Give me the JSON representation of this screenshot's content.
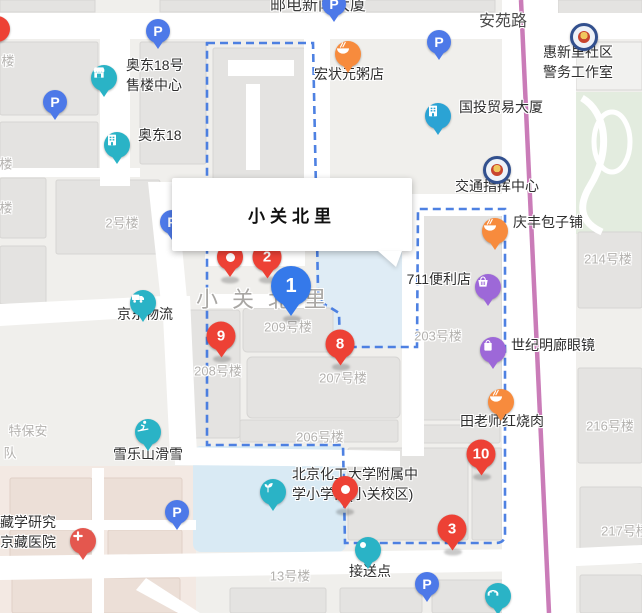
{
  "map": {
    "road_name": "安苑路",
    "top_building_label": "邮电新闻大厦",
    "area_label": "小关北里",
    "info_window": {
      "title": "小关北里"
    },
    "colors": {
      "red_marker": "#ed4135",
      "blue_marker": "#3579ea",
      "parking_blue": "#4d79e8",
      "teal": "#2ab3c6",
      "office_blue": "#2ba3d4",
      "orange": "#f78b3d",
      "purple": "#9d68d8",
      "badge_navy": "#32508e",
      "hospital_red": "#e4574e",
      "boundary_blue": "#3f76e0",
      "metro_pink": "#ca7cb8"
    },
    "boundary_path": "M207,43 L313,43 L318,288 C318,301 323,304 331,308 L339,313 L340,347 L417,347 L418,209 L505,209 L505,534 Q505,543 496,543 L345,543 L343,445 L207,445 Z"
  },
  "numbered_markers": [
    {
      "n": "2",
      "x": 267,
      "y": 257,
      "kind": "red"
    },
    {
      "n": "9",
      "x": 221,
      "y": 336,
      "kind": "red"
    },
    {
      "n": "8",
      "x": 340,
      "y": 344,
      "kind": "red"
    },
    {
      "n": "10",
      "x": 481,
      "y": 454,
      "kind": "red"
    },
    {
      "n": "3",
      "x": 452,
      "y": 529,
      "kind": "red"
    },
    {
      "n": "1",
      "x": 291,
      "y": 286,
      "kind": "blue"
    }
  ],
  "dot_markers": [
    {
      "x": 230,
      "y": 257
    },
    {
      "x": 345,
      "y": 489
    }
  ],
  "partial_marker": {
    "x": -3,
    "y": 29
  },
  "parking_markers": [
    {
      "x": 158,
      "y": 31
    },
    {
      "x": 55,
      "y": 102
    },
    {
      "x": 439,
      "y": 42
    },
    {
      "x": 334,
      "y": 4
    },
    {
      "x": 177,
      "y": 512
    },
    {
      "x": 427,
      "y": 584
    },
    {
      "x": 172,
      "y": 222
    }
  ],
  "pois": [
    {
      "id": "hongzhuangyuan-porridge",
      "icon": "food-icon",
      "color": "#f78b3d",
      "x": 348,
      "y": 54,
      "lines": [
        "宏状元粥店"
      ],
      "lx": 349,
      "ly": 74,
      "align": "center"
    },
    {
      "id": "aodong18-sales-center",
      "icon": "storefront-icon",
      "color": "#2ab3c6",
      "x": 104,
      "y": 78,
      "lines": [
        "奥东18号",
        "售楼中心"
      ],
      "lx": 126,
      "ly": 65,
      "align": "left"
    },
    {
      "id": "aodong18",
      "icon": "building-icon",
      "color": "#2ab3c6",
      "x": 117,
      "y": 145,
      "lines": [
        "奥东18"
      ],
      "lx": 138,
      "ly": 135,
      "align": "left"
    },
    {
      "id": "guotou-trade-tower",
      "icon": "building-icon",
      "color": "#2ba3d4",
      "x": 438,
      "y": 116,
      "lines": [
        "国投贸易大厦"
      ],
      "lx": 459,
      "ly": 107,
      "align": "left"
    },
    {
      "id": "huixinli-police-room",
      "icon": "police-badge-icon",
      "color": "#32508e",
      "x": 584,
      "y": 37,
      "lines": [
        "惠新里社区",
        "警务工作室"
      ],
      "lx": 543,
      "ly": 52,
      "align": "left"
    },
    {
      "id": "traffic-command-center",
      "icon": "police-badge-icon",
      "color": "#32508e",
      "x": 497,
      "y": 170,
      "lines": [
        "交通指挥中心"
      ],
      "lx": 497,
      "ly": 186,
      "align": "center"
    },
    {
      "id": "qingfeng-baozi",
      "icon": "food-icon",
      "color": "#f78b3d",
      "x": 495,
      "y": 231,
      "lines": [
        "庆丰包子铺"
      ],
      "lx": 513,
      "ly": 222,
      "align": "left"
    },
    {
      "id": "711-store",
      "icon": "basket-icon",
      "color": "#9d68d8",
      "x": 488,
      "y": 287,
      "lines": [
        "711便利店"
      ],
      "lx": 471,
      "ly": 279,
      "align": "right"
    },
    {
      "id": "century-glasses",
      "icon": "bag-icon",
      "color": "#9d68d8",
      "x": 493,
      "y": 350,
      "lines": [
        "世纪明廊眼镜"
      ],
      "lx": 511,
      "ly": 345,
      "align": "left"
    },
    {
      "id": "tianlaoshi-braised-pork",
      "icon": "food-icon",
      "color": "#f78b3d",
      "x": 501,
      "y": 402,
      "lines": [
        "田老师红烧肉"
      ],
      "lx": 502,
      "ly": 421,
      "align": "center"
    },
    {
      "id": "jd-logistics",
      "icon": "truck-icon",
      "color": "#2ab3c6",
      "x": 143,
      "y": 303,
      "lines": [
        "京东物流"
      ],
      "lx": 145,
      "ly": 314,
      "align": "center"
    },
    {
      "id": "xueleshan-ski",
      "icon": "ski-icon",
      "color": "#2ab3c6",
      "x": 148,
      "y": 432,
      "lines": [
        "雪乐山滑雪"
      ],
      "lx": 148,
      "ly": 454,
      "align": "center"
    },
    {
      "id": "buct-affiliated-school",
      "icon": "sprout-icon",
      "color": "#2ab3c6",
      "x": 273,
      "y": 492,
      "lines": [
        "北京化工大学附属中",
        "学小学部(小关校区)"
      ],
      "lx": 292,
      "ly": 474,
      "align": "left"
    },
    {
      "id": "pickup-point",
      "icon": "dot-icon",
      "color": "#2ab3c6",
      "x": 368,
      "y": 550,
      "lines": [
        "接送点"
      ],
      "lx": 370,
      "ly": 571,
      "align": "center"
    },
    {
      "id": "footbridge",
      "icon": "bridge-icon",
      "color": "#2ab3c6",
      "x": 498,
      "y": 596,
      "lines": [],
      "lx": 0,
      "ly": 0,
      "align": "left"
    },
    {
      "id": "zangxue-hospital",
      "icon": "cross-icon",
      "color": "#e4574e",
      "x": 83,
      "y": 541,
      "lines": [
        "藏学研究",
        "京藏医院"
      ],
      "lx": 0,
      "ly": 522,
      "align": "left"
    }
  ],
  "building_labels": [
    {
      "t": "2号楼",
      "x": 122,
      "y": 222
    },
    {
      "t": "209号楼",
      "x": 288,
      "y": 326
    },
    {
      "t": "208号楼",
      "x": 218,
      "y": 370
    },
    {
      "t": "207号楼",
      "x": 343,
      "y": 377
    },
    {
      "t": "206号楼",
      "x": 320,
      "y": 436
    },
    {
      "t": "203号楼",
      "x": 438,
      "y": 335
    },
    {
      "t": "214号楼",
      "x": 608,
      "y": 258
    },
    {
      "t": "216号楼",
      "x": 610,
      "y": 425
    },
    {
      "t": "217号楼",
      "x": 625,
      "y": 530
    },
    {
      "t": "13号楼",
      "x": 290,
      "y": 575
    },
    {
      "t": "楼",
      "x": 8,
      "y": 60
    },
    {
      "t": "楼",
      "x": 6,
      "y": 163
    },
    {
      "t": "楼",
      "x": 6,
      "y": 207
    },
    {
      "t": "特保安",
      "x": 28,
      "y": 430
    },
    {
      "t": "队",
      "x": 10,
      "y": 452
    }
  ]
}
